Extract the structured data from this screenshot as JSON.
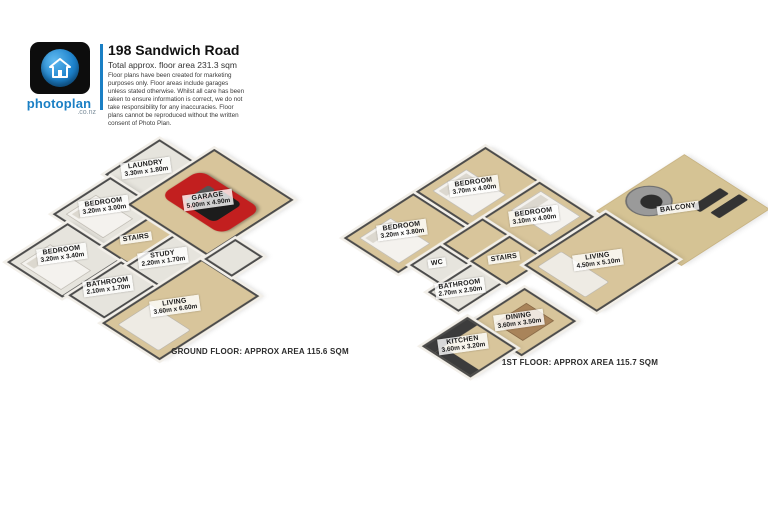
{
  "header": {
    "logo": {
      "brand": "photoplan",
      "tld": ".co.nz",
      "icon": "house-icon"
    },
    "title": "198 Sandwich Road",
    "subtitle": "Total approx. floor area 231.3 sqm",
    "disclaimer": "Floor plans have been created for marketing purposes only. Floor areas include garages unless stated otherwise. Whilst all care has been taken to ensure information is correct, we do not take responsibility for any inaccuracies. Floor plans cannot be reproduced without the written consent of Photo Plan."
  },
  "plans": [
    {
      "name": "ground-floor",
      "caption": "GROUND FLOOR: APPROX AREA 115.6 SQM",
      "rooms": [
        {
          "name": "LAUNDRY",
          "dims": "3.30m x 1.80m"
        },
        {
          "name": "BEDROOM",
          "dims": "3.20m x 3.00m"
        },
        {
          "name": "BEDROOM",
          "dims": "3.20m x 3.40m"
        },
        {
          "name": "BATHROOM",
          "dims": "2.10m x 1.70m"
        },
        {
          "name": "STUDY",
          "dims": "2.20m x 1.70m"
        },
        {
          "name": "STAIRS",
          "dims": ""
        },
        {
          "name": "GARAGE",
          "dims": "5.00m x 4.90m"
        },
        {
          "name": "LIVING",
          "dims": "3.60m x 6.60m"
        }
      ]
    },
    {
      "name": "first-floor",
      "caption": "1ST FLOOR: APPROX AREA 115.7 SQM",
      "rooms": [
        {
          "name": "BEDROOM",
          "dims": "3.70m x 4.00m"
        },
        {
          "name": "BEDROOM",
          "dims": "3.10m x 4.00m"
        },
        {
          "name": "BEDROOM",
          "dims": "3.20m x 3.80m"
        },
        {
          "name": "WC",
          "dims": ""
        },
        {
          "name": "BATHROOM",
          "dims": "2.70m x 2.50m"
        },
        {
          "name": "STAIRS",
          "dims": ""
        },
        {
          "name": "LIVING",
          "dims": "4.50m x 5.10m"
        },
        {
          "name": "DINING",
          "dims": "3.60m x 3.50m"
        },
        {
          "name": "KITCHEN",
          "dims": "3.60m x 3.20m"
        },
        {
          "name": "BALCONY",
          "dims": ""
        }
      ]
    }
  ],
  "colors": {
    "accent_blue": "#1a7fc4",
    "floor_tan": "#d8c59b",
    "floor_light": "#e6e4dd",
    "wall_line": "#4b4b4b",
    "car_red": "#c21f1f"
  }
}
